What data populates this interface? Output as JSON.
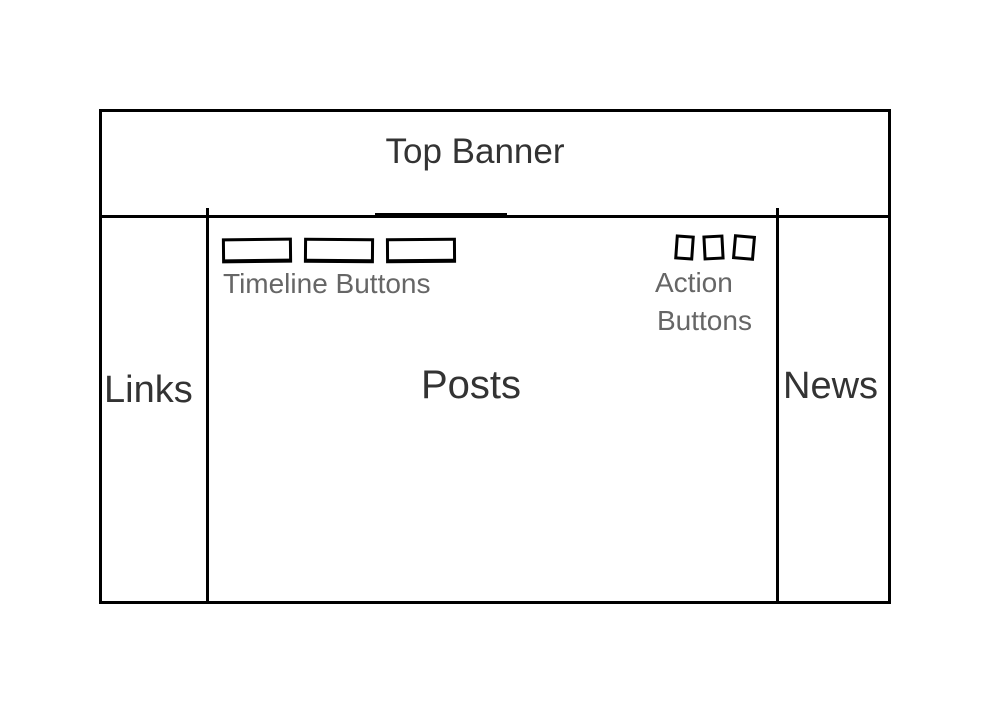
{
  "wireframe": {
    "banner": {
      "label": "Top Banner"
    },
    "left_sidebar": {
      "label": "Links"
    },
    "main": {
      "label": "Posts",
      "timeline": {
        "label": "Timeline Buttons",
        "button_count": 3
      },
      "actions": {
        "label_line1": "Action",
        "label_line2": "Buttons",
        "button_count": 3
      }
    },
    "right_sidebar": {
      "label": "News"
    }
  },
  "colors": {
    "stroke": "#000000",
    "region_label_text": "#333333",
    "caption_text": "#666666",
    "background": "#ffffff"
  }
}
